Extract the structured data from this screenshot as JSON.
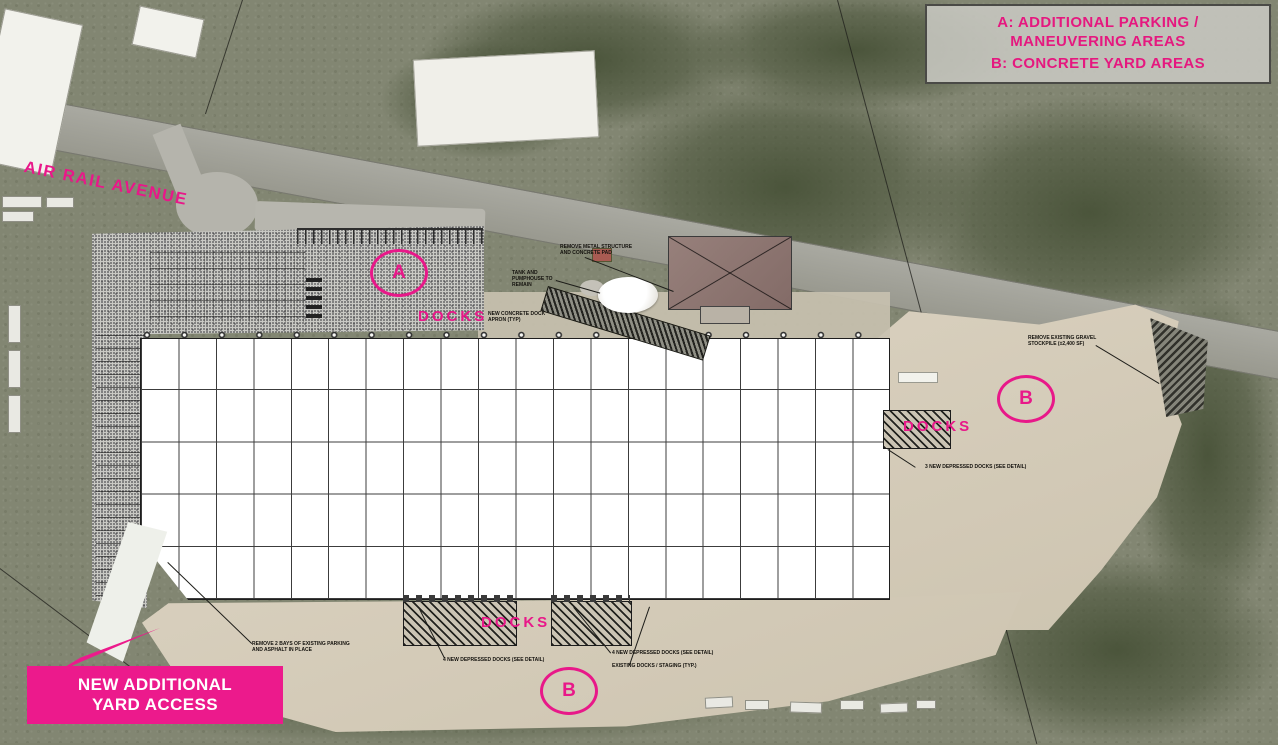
{
  "palette": {
    "magenta": "#e81889",
    "callout_box_magenta": "#ec1a8c",
    "aerial_olive": "#828672",
    "tree_green": "#485238",
    "road_gray": "#a1a199",
    "concrete_tan": "#d3cab8",
    "parking_stipple_gray": "#c9c9c4",
    "building_white": "#ffffff",
    "ink": "#1d1d19"
  },
  "legend": {
    "entry_a": "A: ADDITIONAL PARKING /\nMANEUVERING AREAS",
    "entry_b": "B: CONCRETE YARD AREAS"
  },
  "street_label": "AIR RAIL AVENUE",
  "dock_labels": {
    "north": "DOCKS",
    "east": "DOCKS",
    "south": "DOCKS"
  },
  "area_markers": {
    "a": "A",
    "b_east": "B",
    "b_south": "B"
  },
  "yard_access_callout": "NEW ADDITIONAL\nYARD ACCESS",
  "plan_notes": [
    "REMOVE METAL STRUCTURE AND CONCRETE PAD",
    "TANK AND PUMPHOUSE TO REMAIN",
    "NEW CONCRETE DOCK APRON (TYP)",
    "REMOVE EXISTING GRAVEL STOCKPILE (±2,400 SF)",
    "3 NEW DEPRESSED DOCKS (SEE DETAIL)",
    "4 NEW DEPRESSED DOCKS (SEE DETAIL)",
    "4 NEW DEPRESSED DOCKS (SEE DETAIL)",
    "EXISTING DOCKS / STAGING (TYP.)",
    "REMOVE 2 BAYS OF EXISTING PARKING AND ASPHALT IN PLACE"
  ],
  "building": {
    "grid_columns": 20,
    "grid_rows": 5
  }
}
